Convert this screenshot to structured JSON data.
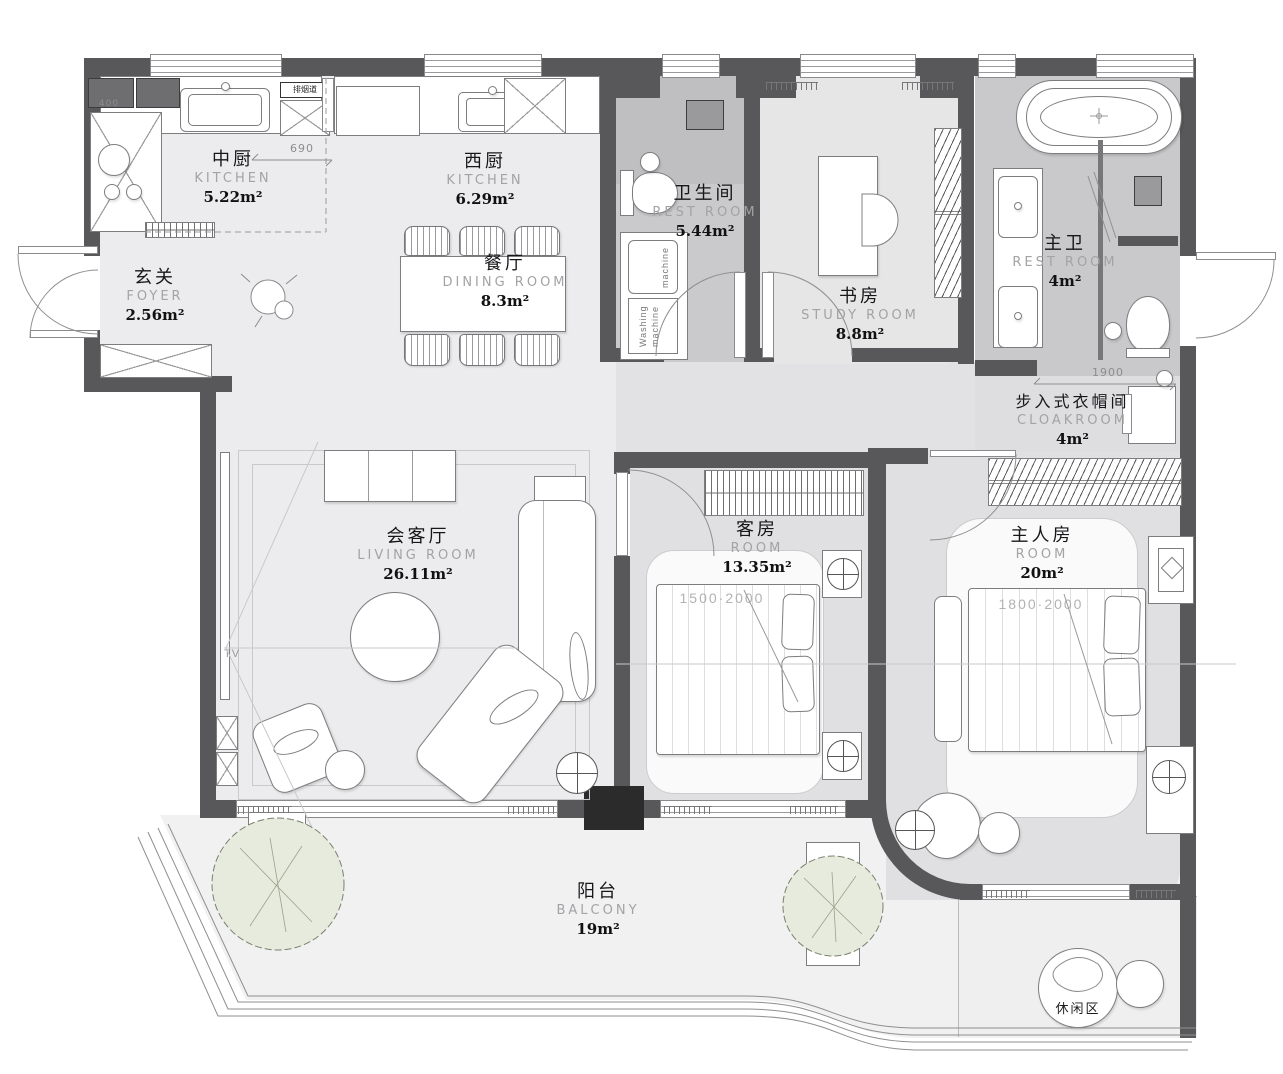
{
  "rooms": {
    "kitchen_cn": {
      "zh": "中厨",
      "en": "KITCHEN",
      "area": "5.22m²"
    },
    "kitchen_west": {
      "zh": "西厨",
      "en": "KITCHEN",
      "area": "6.29m²"
    },
    "foyer": {
      "zh": "玄关",
      "en": "FOYER",
      "area": "2.56m²"
    },
    "dining": {
      "zh": "餐厅",
      "en": "DINING ROOM",
      "area": "8.3m²"
    },
    "restroom": {
      "zh": "卫生间",
      "en": "REST ROOM",
      "area": "5.44m²"
    },
    "study": {
      "zh": "书房",
      "en": "STUDY ROOM",
      "area": "8.8m²"
    },
    "master_bath": {
      "zh": "主卫",
      "en": "REST ROOM",
      "area": "4m²"
    },
    "cloakroom": {
      "zh": "步入式衣帽间",
      "en": "CLOAKROOM",
      "area": "4m²"
    },
    "living": {
      "zh": "会客厅",
      "en": "LIVING ROOM",
      "area": "26.11m²"
    },
    "guest": {
      "zh": "客房",
      "en": "ROOM",
      "area": "13.35m²"
    },
    "master": {
      "zh": "主人房",
      "en": "ROOM",
      "area": "20m²"
    },
    "balcony": {
      "zh": "阳台",
      "en": "BALCONY",
      "area": "19m²"
    }
  },
  "annotations": {
    "leisure_area": "休闲区",
    "tv_label": "TV",
    "flue_label": "排烟道",
    "washer_top": "machine",
    "washer_bottom_1": "Washing",
    "washer_bottom_2": "machine"
  },
  "dimensions": {
    "d690": "690",
    "d400": "400",
    "d1900": "1900",
    "guest_bed": "1500·2000",
    "master_bed": "1800·2000"
  },
  "colors": {
    "wall": "#58585a",
    "floor_light": "#ececee",
    "floor_mid": "#e0e0e2",
    "floor_dark": "#c9c9cb",
    "balcony": "#f1f1f2",
    "tree": "#e6ebdd",
    "pillar": "#2b2b2c"
  }
}
